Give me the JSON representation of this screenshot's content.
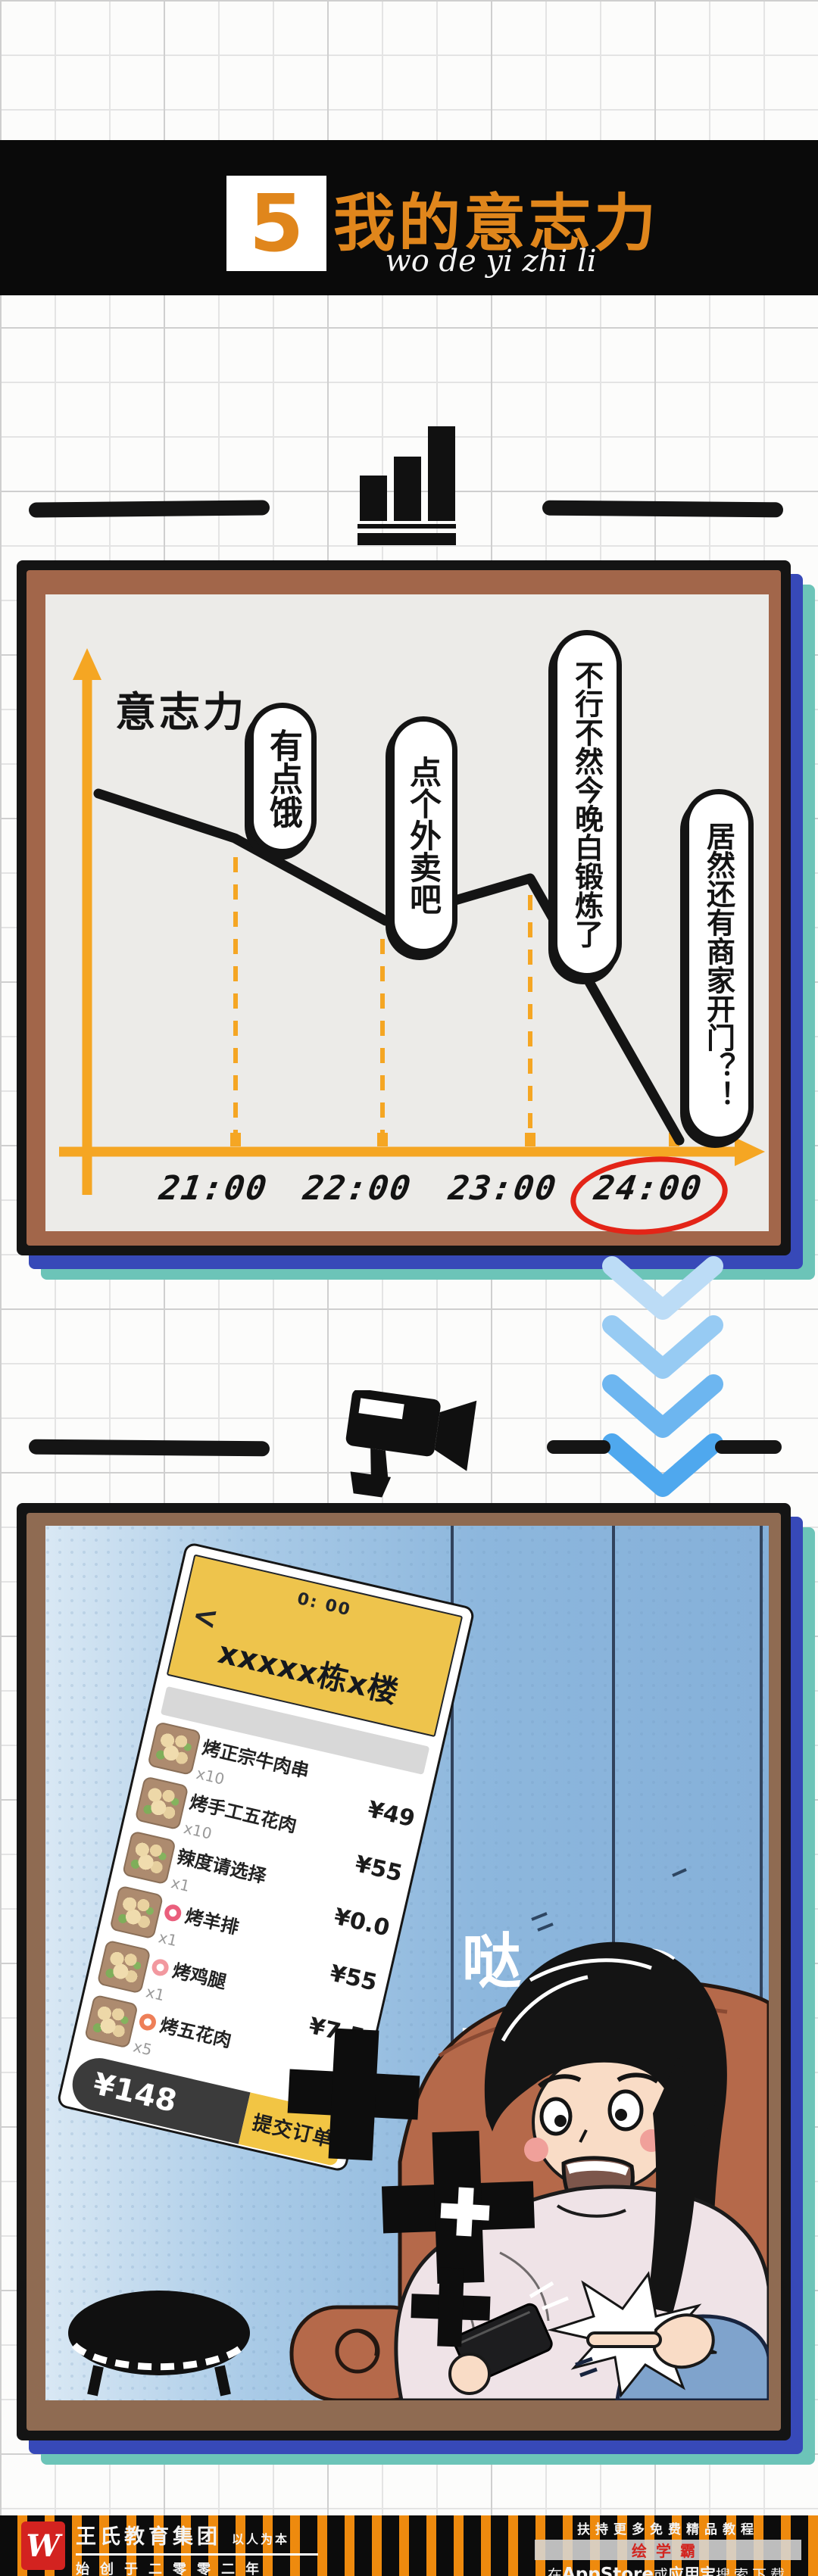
{
  "header": {
    "number": "5",
    "title": "我的意志力",
    "subtitle": "wo de yi zhi li"
  },
  "chart_data": {
    "type": "line",
    "title": "",
    "ylabel": "意志力",
    "xlabel": "",
    "x_ticks": [
      "21:00",
      "22:00",
      "23:00",
      "24:00"
    ],
    "highlighted_tick": "24:00",
    "points": [
      {
        "t": "20:20",
        "v": 74
      },
      {
        "t": "21:00",
        "v": 65
      },
      {
        "t": "22:00",
        "v": 48
      },
      {
        "t": "23:00",
        "v": 56
      },
      {
        "t": "24:00",
        "v": 2
      }
    ],
    "ylim": [
      0,
      100
    ],
    "grid": false,
    "line_color": "#141414",
    "axis_color": "#f5a623",
    "annotations": [
      {
        "x": "21:00",
        "text": "有点饿"
      },
      {
        "x": "22:00",
        "text": "点个外卖吧"
      },
      {
        "x": "23:00",
        "text": "不行不然今晚白锻炼了"
      },
      {
        "x": "24:00",
        "text": "居然还有商家开门？！"
      }
    ]
  },
  "phone": {
    "status_time": "0: 00",
    "back": "<",
    "title": "xxxxx栋x楼",
    "rows": [
      {
        "name": "烤正宗牛肉串",
        "qty": "x10",
        "price": "¥49"
      },
      {
        "name": "烤手工五花肉",
        "qty": "x10",
        "price": "¥55"
      },
      {
        "name": "辣度请选择",
        "qty": "x1",
        "price": "¥0.0"
      },
      {
        "name": "烤羊排",
        "qty": "x1",
        "price": "¥55"
      },
      {
        "name": "烤鸡腿",
        "qty": "x1",
        "price": "¥7.5"
      },
      {
        "name": "烤五花肉",
        "qty": "x5",
        "price": "¥15"
      }
    ],
    "total": "¥148",
    "submit": "提交订单"
  },
  "stickers": [
    "哒",
    "哒",
    "哒"
  ],
  "footer": {
    "logo_glyph": "W",
    "brand": "王氏教育集团",
    "slogan": "以人为本",
    "founded": "始创于二零零二年",
    "right_line1": "扶持更多免费精品教程",
    "app_name": "绘学霸",
    "store_prefix": "在",
    "store1": "AppStore",
    "or": "或",
    "store2": "应用宝",
    "store_suffix": "搜索下载"
  },
  "colors": {
    "accent_orange": "#e0861c",
    "axis_orange": "#f5a623",
    "panel_brown": "#a2664a",
    "shadow_blue": "#3749b8",
    "shadow_teal": "#6cc4b8",
    "scene_blue": "#8fb9de",
    "highlight_red": "#e32417",
    "stripe_orange": "#ee8a0e"
  }
}
